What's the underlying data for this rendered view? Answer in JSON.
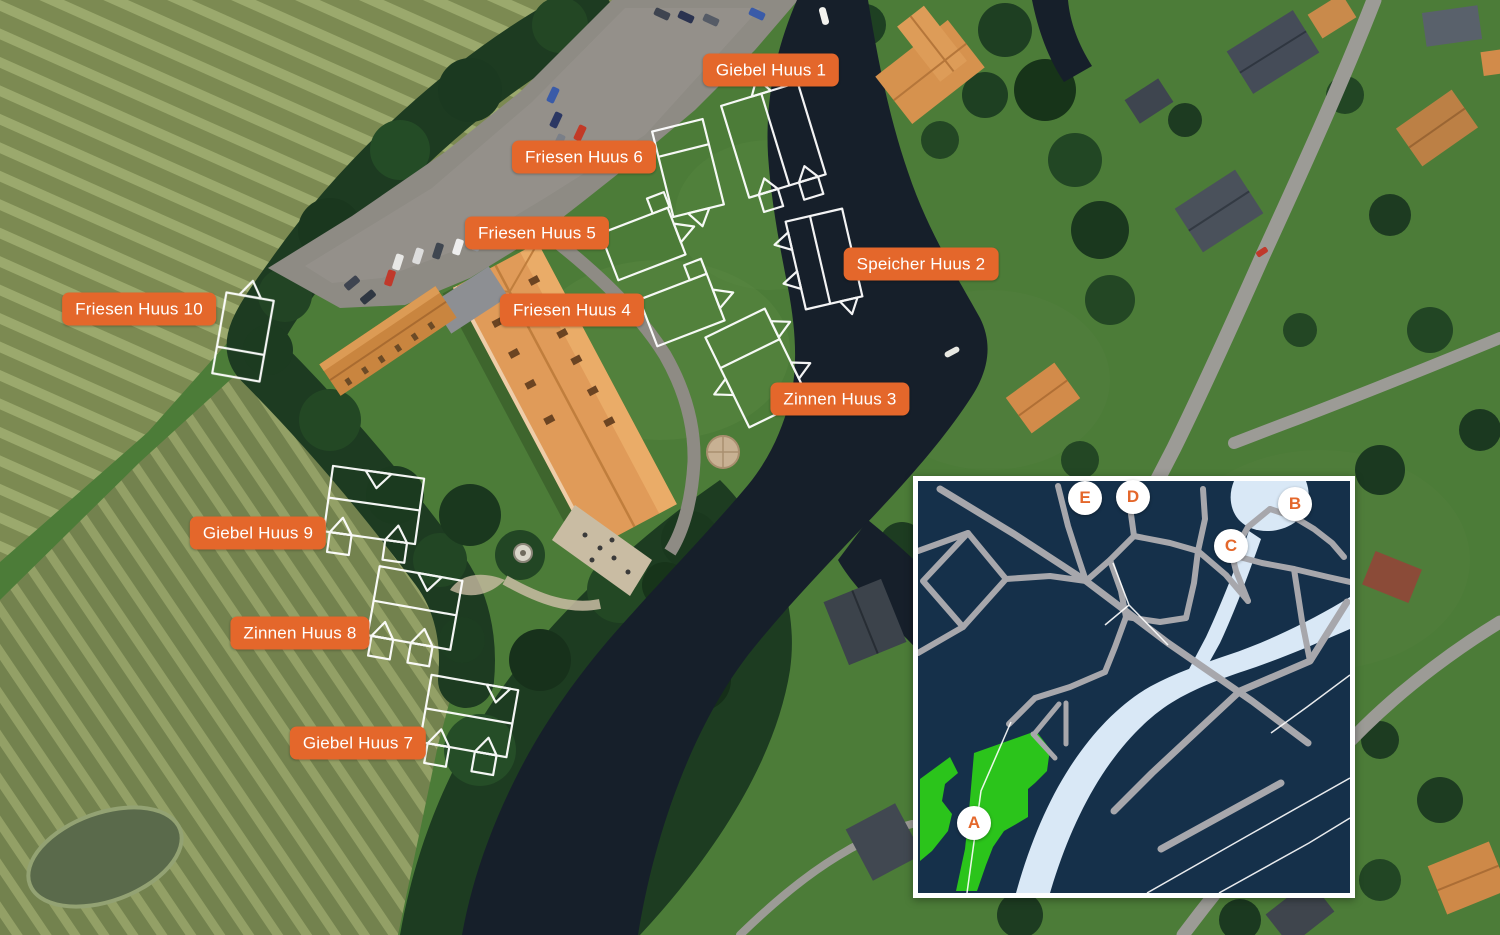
{
  "map_labels": [
    {
      "text": "Giebel Huus 1",
      "x": 771,
      "y": 70
    },
    {
      "text": "Friesen Huus 6",
      "x": 584,
      "y": 157
    },
    {
      "text": "Friesen Huus 5",
      "x": 537,
      "y": 233
    },
    {
      "text": "Speicher Huus 2",
      "x": 921,
      "y": 264
    },
    {
      "text": "Friesen Huus 4",
      "x": 572,
      "y": 310
    },
    {
      "text": "Friesen Huus 10",
      "x": 139,
      "y": 309
    },
    {
      "text": "Zinnen Huus 3",
      "x": 840,
      "y": 399
    },
    {
      "text": "Giebel Huus 9",
      "x": 258,
      "y": 533
    },
    {
      "text": "Zinnen Huus 8",
      "x": 300,
      "y": 633
    },
    {
      "text": "Giebel Huus 7",
      "x": 358,
      "y": 743
    }
  ],
  "inset_map": {
    "markers": [
      {
        "letter": "A",
        "x": 56,
        "y": 342
      },
      {
        "letter": "B",
        "x": 377,
        "y": 23
      },
      {
        "letter": "C",
        "x": 313,
        "y": 65
      },
      {
        "letter": "D",
        "x": 215,
        "y": 16
      },
      {
        "letter": "E",
        "x": 167,
        "y": 17
      }
    ]
  },
  "colors": {
    "label_background": "#E4672B",
    "label_text": "#FFFFFF",
    "plan_outline": "#FFFFFF",
    "inset_background": "#15304A",
    "inset_road": "#A7A7AC",
    "inset_water": "#D9E8F6",
    "inset_area_green": "#2BC41B",
    "marker_background": "#FFFFFF",
    "marker_letter": "#E4672B"
  }
}
